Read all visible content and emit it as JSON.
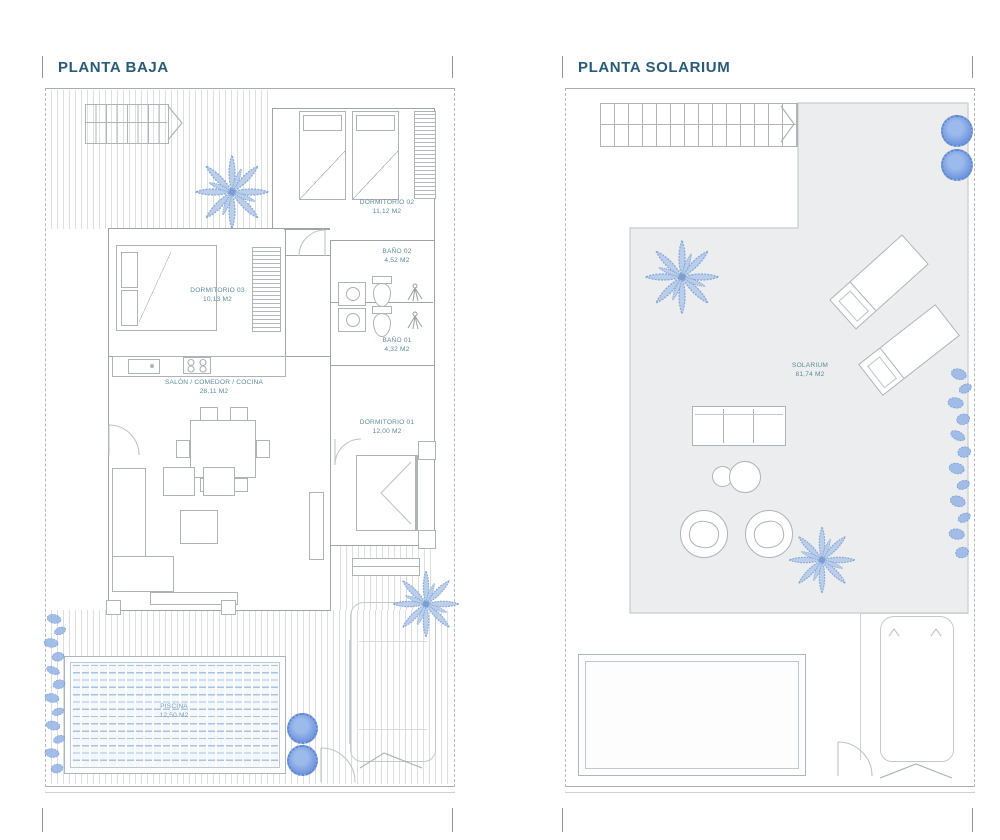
{
  "plans": {
    "baja": {
      "title": "PLANTA BAJA",
      "rooms": {
        "d02": {
          "name": "DORMITORIO 02",
          "area": "11,12 M2"
        },
        "b02": {
          "name": "BAÑO 02",
          "area": "4,52 M2"
        },
        "d03": {
          "name": "DORMITORIO 03",
          "area": "10,13 M2"
        },
        "b01": {
          "name": "BAÑO 01",
          "area": "4,32 M2"
        },
        "salon": {
          "name": "SALÓN / COMEDOR / COCINA",
          "area": "28,11 M2"
        },
        "d01": {
          "name": "DORMITORIO 01",
          "area": "12,00 M2"
        },
        "piscina": {
          "name": "PISCINA",
          "area": "12,50 M2"
        }
      }
    },
    "solarium": {
      "title": "PLANTA SOLARIUM",
      "rooms": {
        "sol": {
          "name": "SOLARIUM",
          "area": "81,74 M2"
        }
      }
    }
  },
  "colors": {
    "title_text": "#2a5b76",
    "room_label": "#5f8b9b",
    "piscina_label": "#7b9cc9",
    "wall_line": "#9ea4a7",
    "light_line": "#c5c8ca",
    "vegetation_blue": "#7b9fd0",
    "bush_blue": "#7298de",
    "pool_dash": "#a9c4e2",
    "solarium_fill": "#ecedee"
  }
}
